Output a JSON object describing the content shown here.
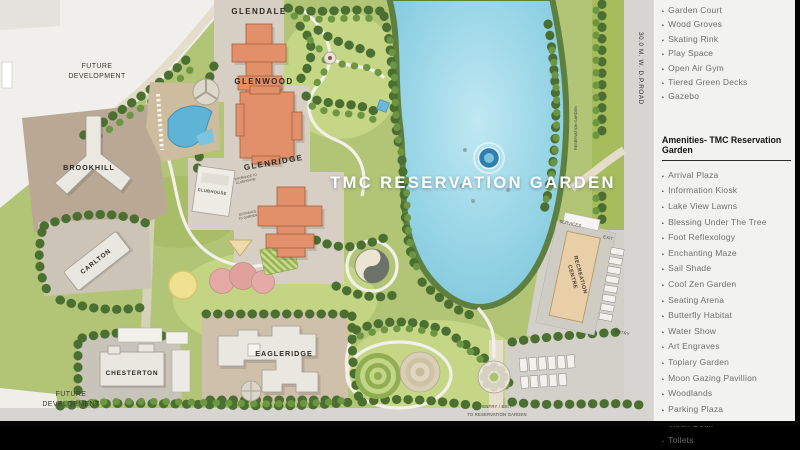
{
  "map": {
    "title": "TMC RESERVATION GARDEN",
    "labels": {
      "glendale": "GLENDALE",
      "glenwood": "GLENWOOD",
      "glenridge": "GLENRIDGE",
      "clubhouse": "CLUBHOUSE",
      "brookhill": "BROOKHILL",
      "carlton": "CARLTON",
      "chesterton": "CHESTERTON",
      "eagleridge": "EAGLERIDGE",
      "recreation_line1": "RECREATION",
      "recreation_line2": "CENTRE",
      "future_line1": "FUTURE",
      "future_line2": "DEVELOPMENT",
      "road": "30.0 M. W. D.P.ROAD",
      "reservation_garden_edge": "RESERVATION GARDEN",
      "services": "SERVICES",
      "exit": "EXIT",
      "entry": "ENTRY",
      "entry_exit_line1": "ENTRY / EXIT",
      "entry_exit_line2": "TO RESERVATION GARDEN",
      "entrance_clubhouse_line1": "ENTRANCE TO",
      "entrance_clubhouse_line2": "CLUBHOUSE",
      "entrance_garden_line1": "ENTRANCE",
      "entrance_garden_line2": "TO GARDEN"
    },
    "colors": {
      "lake": "#8fd0e2",
      "grass": "#b2c576",
      "tower_orange": "#e2906a",
      "road_grey": "#d6d4d0",
      "plot_beige": "#d3c9ba"
    }
  },
  "sidebar": {
    "top_list": [
      "Garden Court",
      "Wood Groves",
      "Skating Rink",
      "Play Space",
      "Open Air Gym",
      "Tiered Green Decks",
      "Gazebo"
    ],
    "heading": "Amenities- TMC Reservation Garden",
    "amenities": [
      "Arrival Plaza",
      "Information Kiosk",
      "Lake View Lawns",
      "Blessing Under The Tree",
      "Foot Reflexology",
      "Enchanting Maze",
      "Sail Shade",
      "Cool Zen Garden",
      "Seating Arena",
      "Butterfly Habitat",
      "Water Show",
      "Art Engraves",
      "Topiary Garden",
      "Moon Gazing Pavillion",
      "Woodlands",
      "Parking Plaza",
      "Moon Deck",
      "Toilets"
    ]
  }
}
